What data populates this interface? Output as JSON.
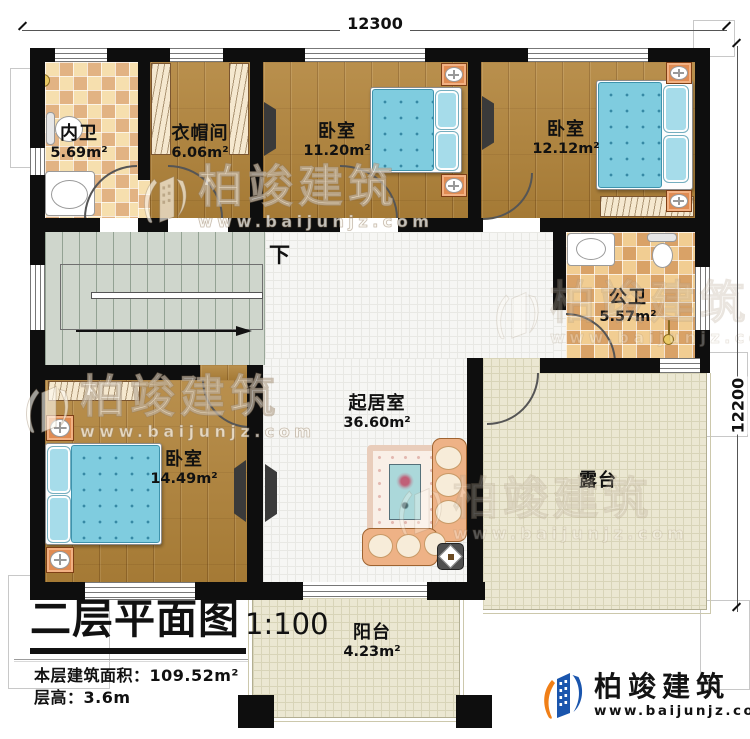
{
  "dimensions": {
    "top": "12300",
    "right": "12200"
  },
  "stairs": {
    "down": "下"
  },
  "rooms": {
    "bath_inner": {
      "name": "内卫",
      "area": "5.69m²"
    },
    "cloakroom": {
      "name": "衣帽间",
      "area": "6.06m²"
    },
    "bedroom_a": {
      "name": "卧室",
      "area": "11.20m²"
    },
    "bedroom_b": {
      "name": "卧室",
      "area": "12.12m²"
    },
    "bath_public": {
      "name": "公卫",
      "area": "5.57m²"
    },
    "bedroom_c": {
      "name": "卧室",
      "area": "14.49m²"
    },
    "living_room": {
      "name": "起居室",
      "area": "36.60m²"
    },
    "terrace": {
      "name": "露台"
    },
    "balcony": {
      "name": "阳台",
      "area": "4.23m²"
    }
  },
  "title_block": {
    "title": "二层平面图",
    "scale": "1:100",
    "floor_area_label": "本层建筑面积：",
    "floor_area_value": "109.52m²",
    "floor_height_label": "层高：",
    "floor_height_value": "3.6m"
  },
  "brand": {
    "name": "柏竣建筑",
    "url": "www.baijunjz.com"
  },
  "watermark": {
    "name": "柏竣建筑",
    "url": "www.baijunjz.com"
  },
  "colors": {
    "wall": "#0e0e0e",
    "brand_blue": "#1a55ad",
    "brand_orange": "#f07f17",
    "bed_blue": "#7fccdf"
  }
}
